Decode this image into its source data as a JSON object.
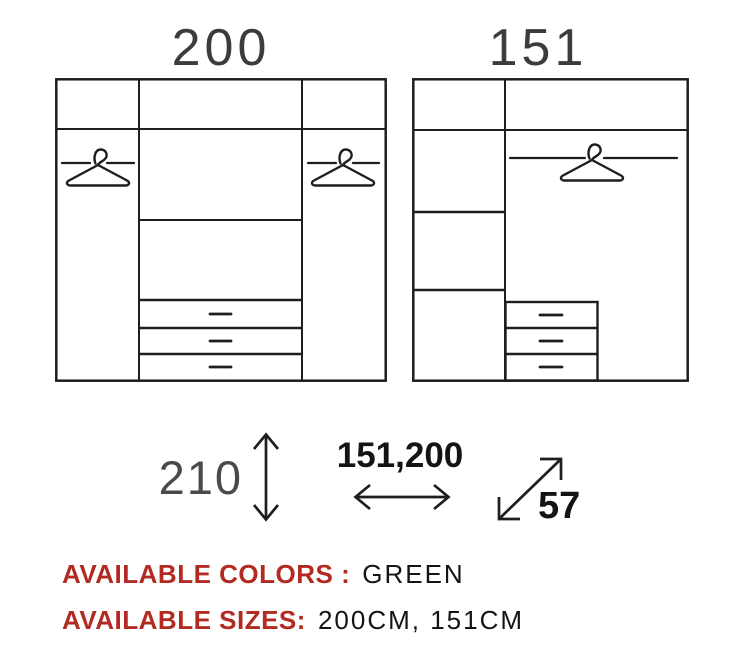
{
  "diagrams": {
    "wardrobe_200": {
      "label": "200"
    },
    "wardrobe_151": {
      "label": "151"
    }
  },
  "dimensions": {
    "height": "210",
    "width": "151,200",
    "depth": "57"
  },
  "footer": {
    "colors_label": "AVAILABLE COLORS :",
    "colors_value": "GREEN",
    "sizes_label": "AVAILABLE SIZES:",
    "sizes_value": "200CM, 151CM"
  },
  "colors": {
    "accent_red": "#b22a21",
    "line_dark": "#1e1e1e",
    "title_gray": "#3c3c3c",
    "dim_gray": "#4a4a4a",
    "text_black": "#141414"
  },
  "icons": {
    "hanger": "clothes-hanger",
    "height_arrow": "vertical-double-arrow",
    "width_arrow": "horizontal-double-arrow",
    "depth_arrow": "diagonal-double-arrow"
  }
}
